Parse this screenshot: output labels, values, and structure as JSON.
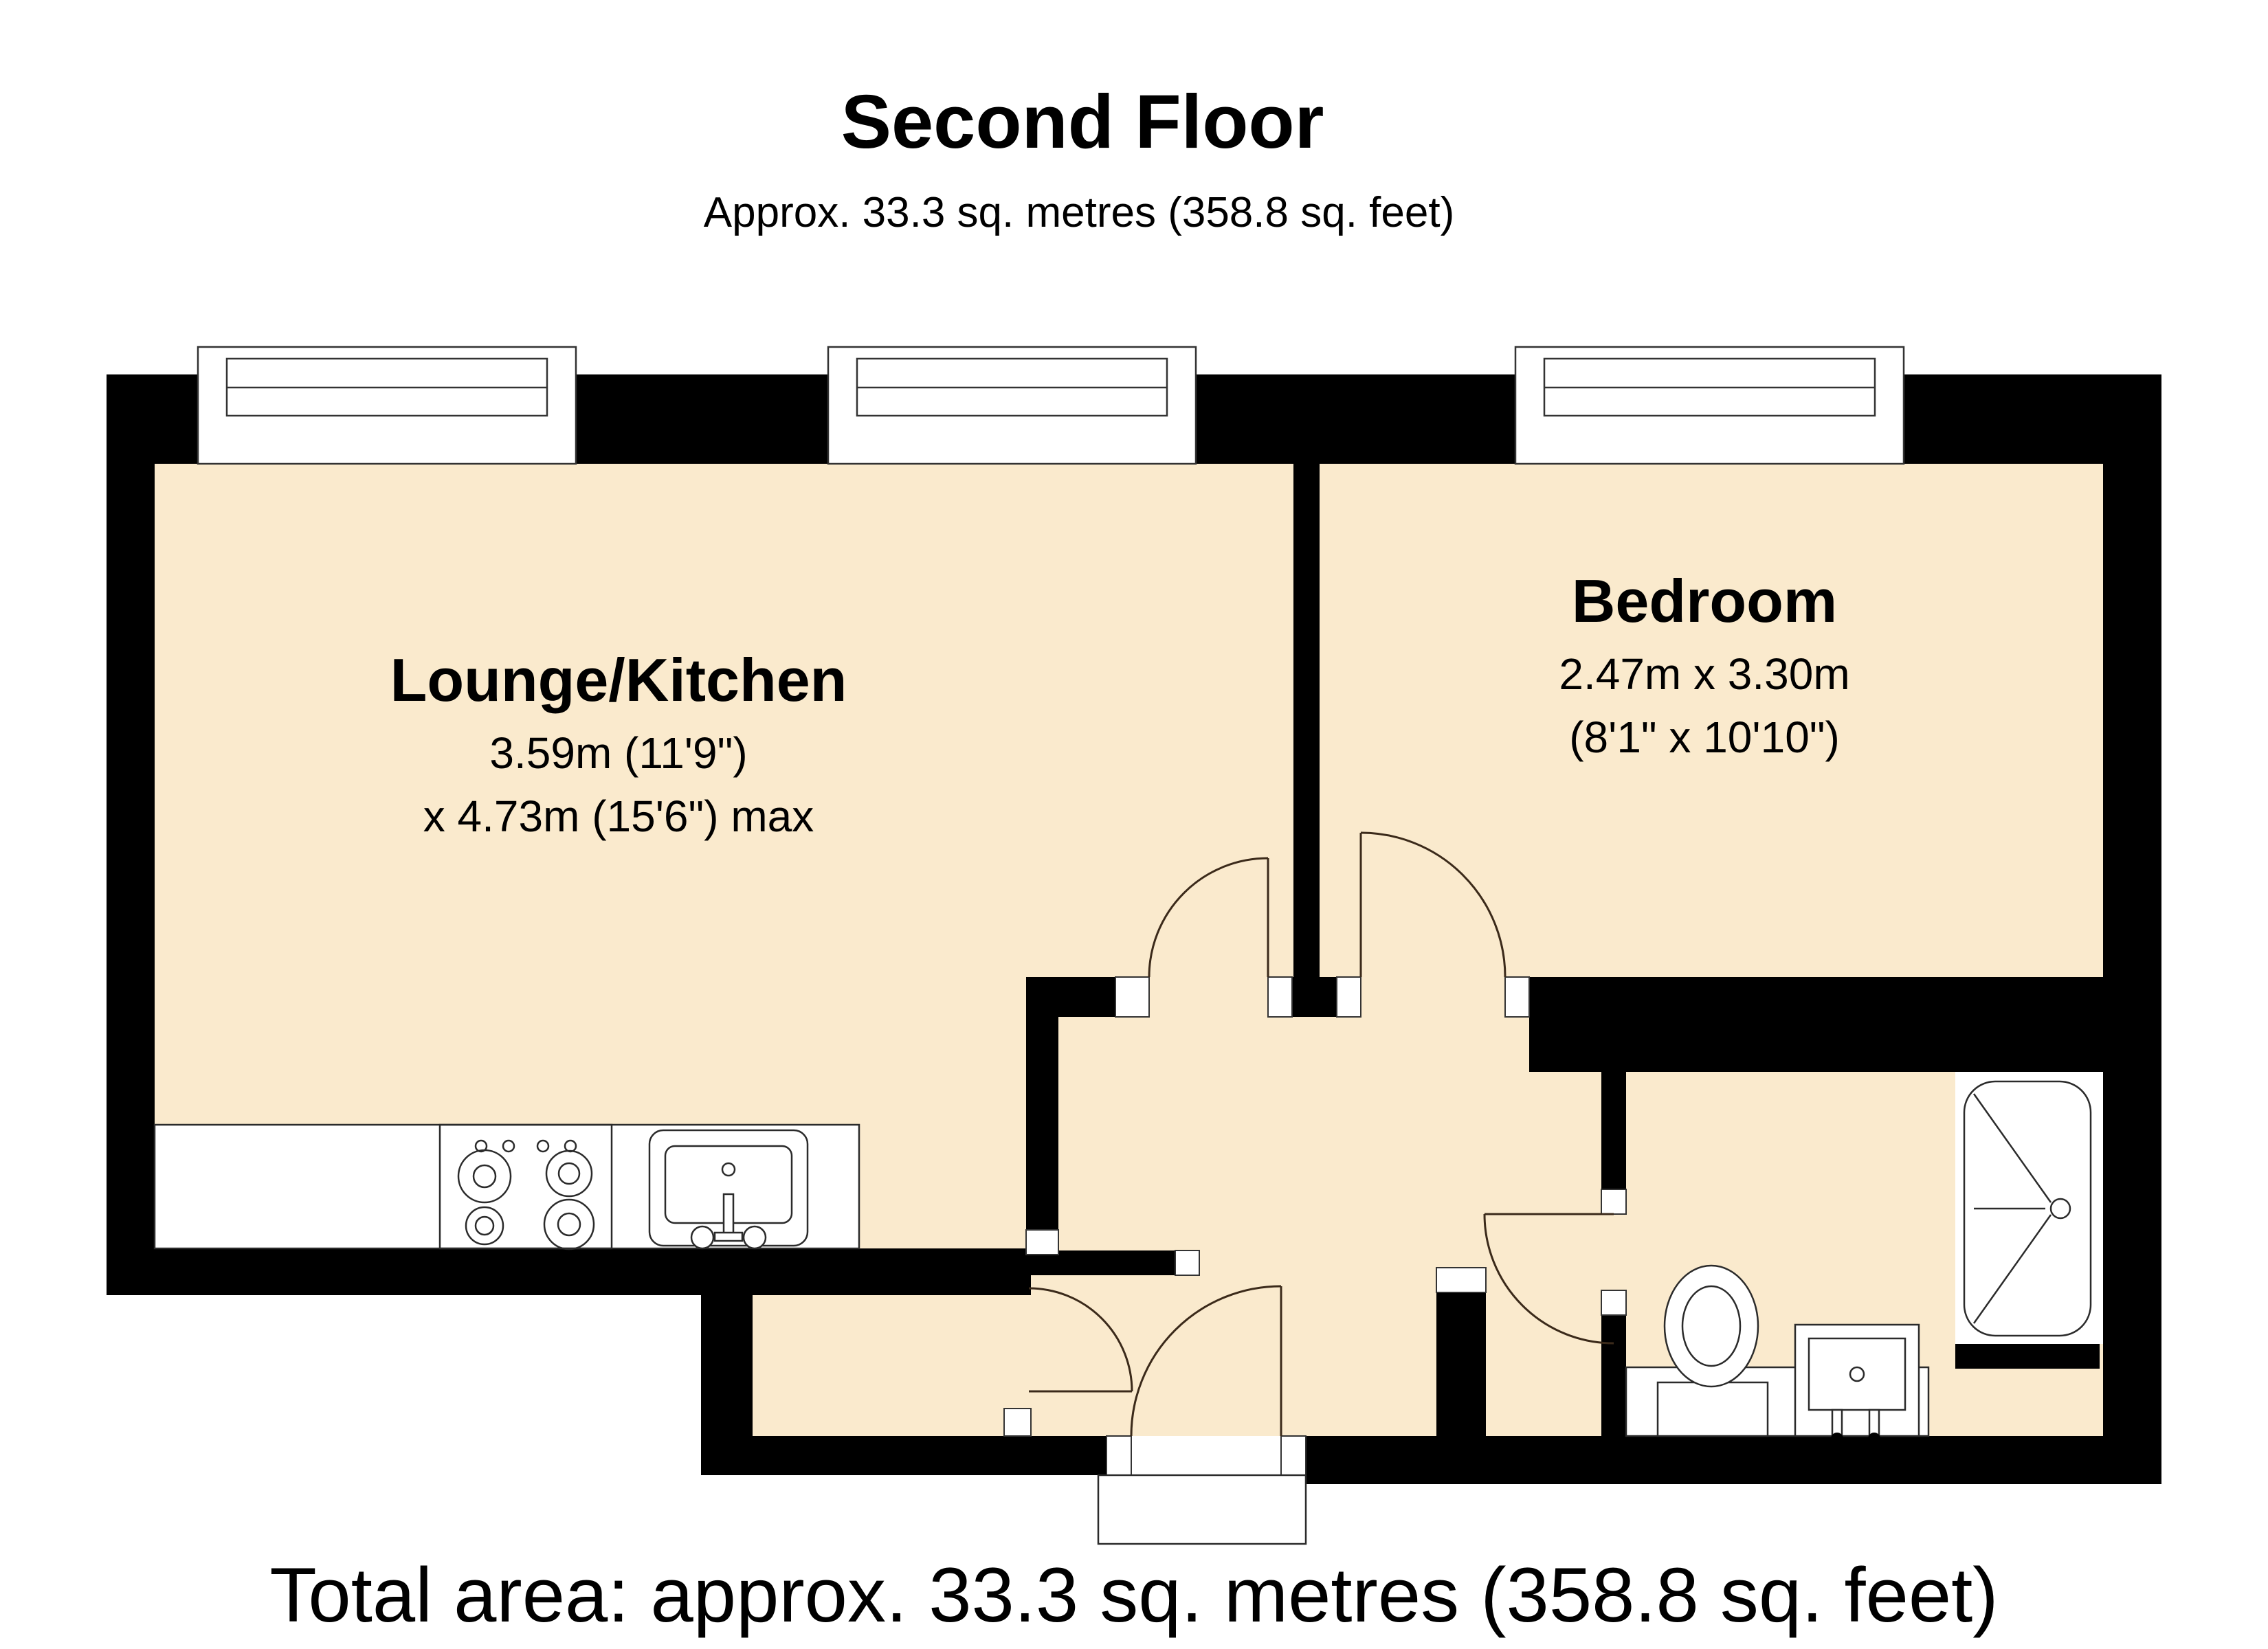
{
  "header": {
    "title": "Second Floor",
    "subtitle": "Approx. 33.3 sq. metres (358.8 sq. feet)"
  },
  "footer": {
    "total_area": "Total area: approx. 33.3 sq. metres (358.8 sq. feet)"
  },
  "rooms": [
    {
      "name": "Lounge/Kitchen",
      "dim_line1": "3.59m (11'9\")",
      "dim_line2": "x 4.73m (15'6\") max"
    },
    {
      "name": "Bedroom",
      "dim_line1": "2.47m x 3.30m",
      "dim_line2": "(8'1\" x 10'10\")"
    }
  ],
  "fixtures": [
    "hob",
    "kitchen-sink",
    "toilet",
    "washbasin",
    "bathtub"
  ],
  "windows": [
    "lounge-window-left",
    "lounge-window-right",
    "bedroom-window"
  ],
  "doors": [
    "lounge-door",
    "bedroom-door",
    "bathroom-door",
    "vestibule-door",
    "entrance-door"
  ],
  "colors": {
    "wall": "#000000",
    "floor": "#FAEACD",
    "background": "#FFFFFF",
    "line": "#3B2A1A"
  }
}
